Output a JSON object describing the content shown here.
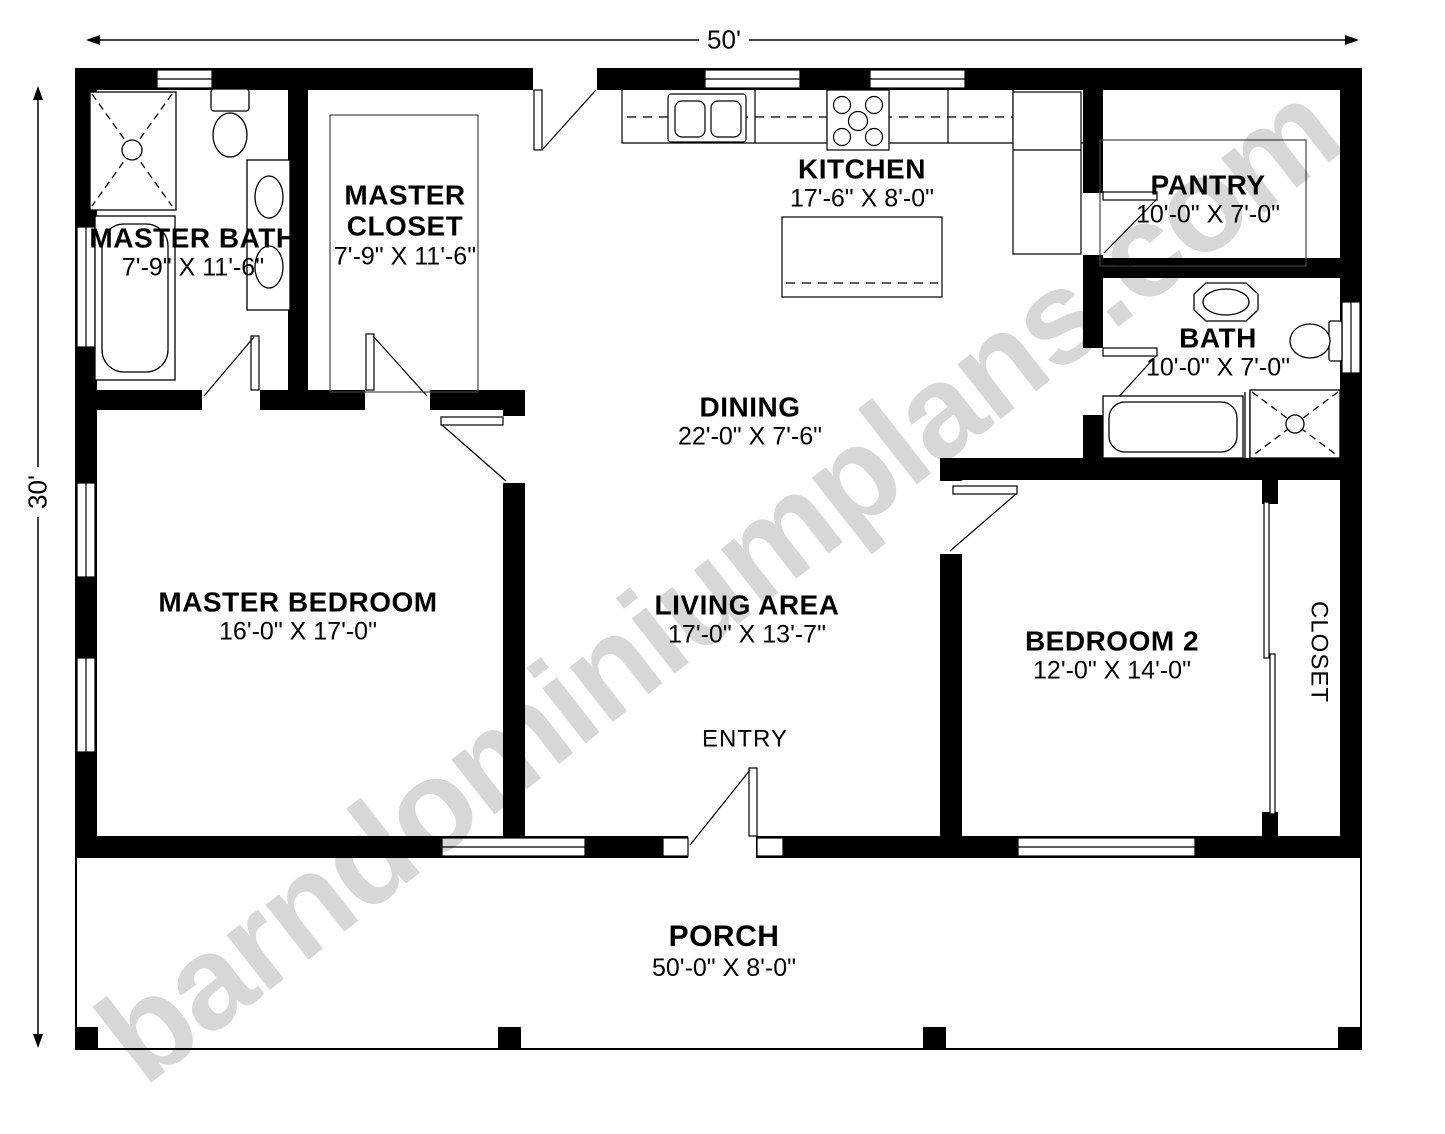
{
  "watermark": "barndominiumplans.com",
  "colors": {
    "walls": "#000000",
    "watermark_gray": "#d7d7d7"
  },
  "dimensions": {
    "width_label": "50'",
    "height_label": "30'"
  },
  "rooms": {
    "master_bath": {
      "name": "MASTER BATH",
      "size": "7'-9\" X 11'-6\""
    },
    "master_closet": {
      "name_line1": "MASTER",
      "name_line2": "CLOSET",
      "size": "7'-9\" X 11'-6\""
    },
    "kitchen": {
      "name": "KITCHEN",
      "size": "17'-6\" X 8'-0\""
    },
    "pantry": {
      "name": "PANTRY",
      "size": "10'-0\" X 7'-0\""
    },
    "bath": {
      "name": "BATH",
      "size": "10'-0\" X 7'-0\""
    },
    "dining": {
      "name": "DINING",
      "size": "22'-0\" X 7'-6\""
    },
    "master_bedroom": {
      "name": "MASTER BEDROOM",
      "size": "16'-0\" X 17'-0\""
    },
    "living_area": {
      "name": "LIVING AREA",
      "size": "17'-0\" X 13'-7\""
    },
    "bedroom2": {
      "name": "BEDROOM 2",
      "size": "12'-0\" X 14'-0\""
    },
    "closet": {
      "name": "CLOSET"
    },
    "entry": {
      "name": "ENTRY"
    },
    "porch": {
      "name": "PORCH",
      "size": "50'-0\" X 8'-0\""
    }
  }
}
